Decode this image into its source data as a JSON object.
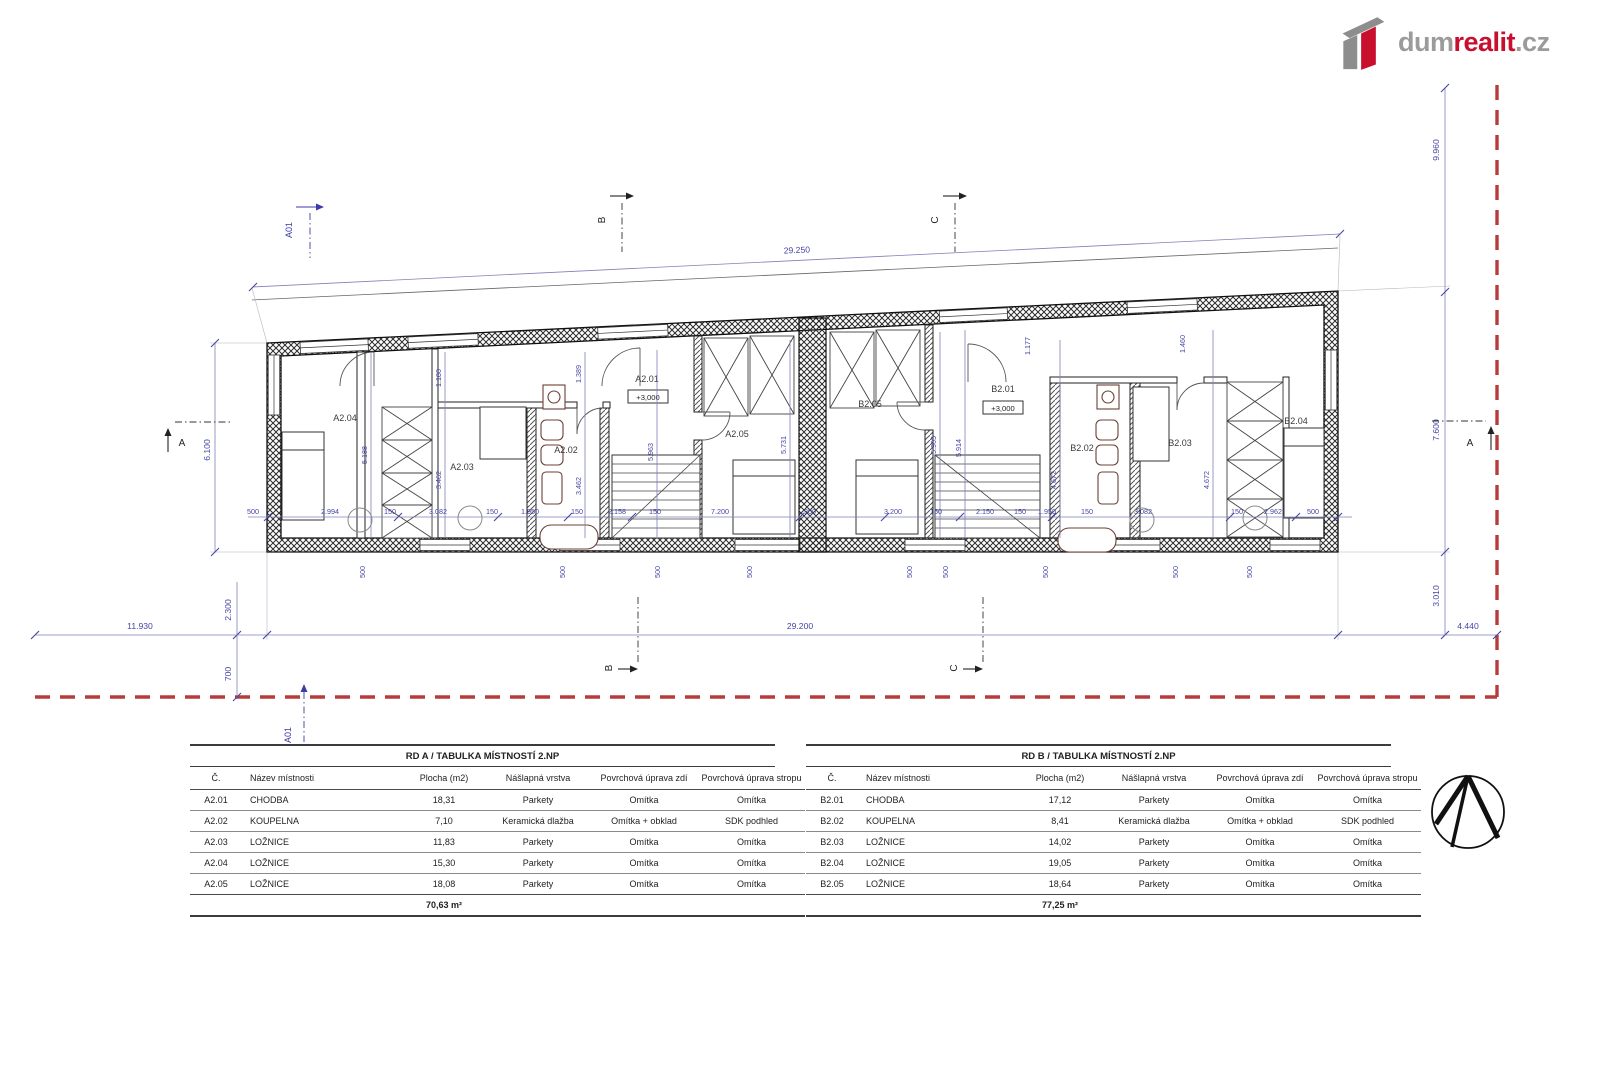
{
  "logo": {
    "part1": "dum",
    "part2": "realit",
    "part3": ".cz"
  },
  "colors": {
    "logo_red": "#c8102e",
    "logo_gray": "#9b9b9b",
    "boundary_red": "#b63c3c",
    "dim_blue": "#4545a5"
  },
  "plan": {
    "rooms": {
      "a04": "A2.04",
      "a03": "A2.03",
      "a02": "A2.02",
      "a01": "A2.01",
      "a05": "A2.05",
      "b05": "B2.05",
      "b01": "B2.01",
      "b02": "B2.02",
      "b03": "B2.03",
      "b04": "B2.04"
    },
    "level": "+3,000",
    "sections": {
      "a01": "A01",
      "a": "A",
      "b": "B",
      "c": "C"
    },
    "dims": {
      "top": "29.250",
      "bottom": "29.200",
      "left_bottom": "11.930",
      "left_height": "6.100",
      "right_top": "9.960",
      "right_mid": "7.600",
      "right_low": "3.010",
      "right_bottom": "4.440",
      "v2300": "2.300",
      "v700": "700",
      "fivehundred": "500",
      "row": [
        "500",
        "2.994",
        "150",
        "3.082",
        "150",
        "1.950",
        "150",
        "2.158",
        "150",
        "7.200",
        "300",
        "3.200",
        "150",
        "2.150",
        "150",
        "1.950",
        "150",
        "3.082",
        "150",
        "2.962",
        "500"
      ],
      "verticals": {
        "d5188": "5.188",
        "d1180": "1.180",
        "d3462a": "3.462",
        "d1389": "1.389",
        "d3462b": "3.462",
        "d5963": "5.963",
        "d5731": "5.731",
        "d5905": "5.905",
        "d5914": "5.914",
        "d4672a": "4.672",
        "d4672b": "4.672",
        "d1177": "1.177",
        "d1460": "1.460"
      }
    }
  },
  "tables": {
    "a": {
      "title": "RD A / TABULKA MÍSTNOSTÍ 2.NP",
      "headers": [
        "Č.",
        "Název místnosti",
        "Plocha (m2)",
        "Nášlapná vrstva",
        "Povrchová úprava zdí",
        "Povrchová úprava stropu"
      ],
      "rows": [
        [
          "A2.01",
          "CHODBA",
          "18,31",
          "Parkety",
          "Omítka",
          "Omítka"
        ],
        [
          "A2.02",
          "KOUPELNA",
          "7,10",
          "Keramická dlažba",
          "Omítka + obklad",
          "SDK podhled"
        ],
        [
          "A2.03",
          "LOŽNICE",
          "11,83",
          "Parkety",
          "Omítka",
          "Omítka"
        ],
        [
          "A2.04",
          "LOŽNICE",
          "15,30",
          "Parkety",
          "Omítka",
          "Omítka"
        ],
        [
          "A2.05",
          "LOŽNICE",
          "18,08",
          "Parkety",
          "Omítka",
          "Omítka"
        ]
      ],
      "total": "70,63 m²"
    },
    "b": {
      "title": "RD B / TABULKA MÍSTNOSTÍ 2.NP",
      "headers": [
        "Č.",
        "Název místnosti",
        "Plocha (m2)",
        "Nášlapná vrstva",
        "Povrchová úprava zdí",
        "Povrchová úprava stropu"
      ],
      "rows": [
        [
          "B2.01",
          "CHODBA",
          "17,12",
          "Parkety",
          "Omítka",
          "Omítka"
        ],
        [
          "B2.02",
          "KOUPELNA",
          "8,41",
          "Keramická dlažba",
          "Omítka + obklad",
          "SDK podhled"
        ],
        [
          "B2.03",
          "LOŽNICE",
          "14,02",
          "Parkety",
          "Omítka",
          "Omítka"
        ],
        [
          "B2.04",
          "LOŽNICE",
          "19,05",
          "Parkety",
          "Omítka",
          "Omítka"
        ],
        [
          "B2.05",
          "LOŽNICE",
          "18,64",
          "Parkety",
          "Omítka",
          "Omítka"
        ]
      ],
      "total": "77,25 m²"
    }
  }
}
